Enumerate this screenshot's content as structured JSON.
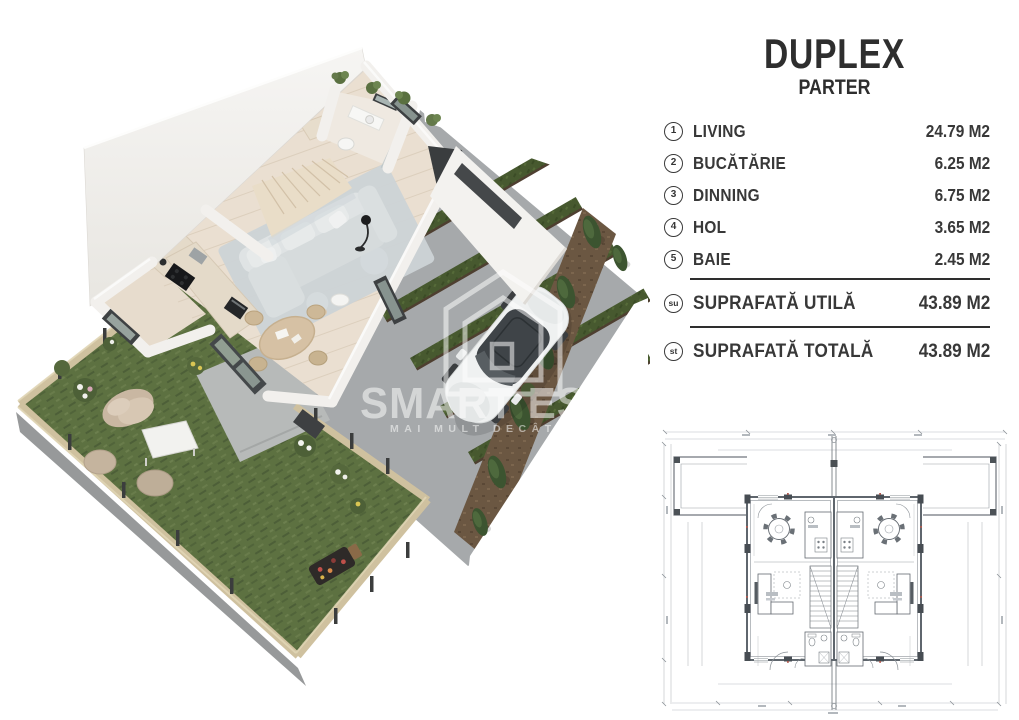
{
  "panel": {
    "title": "DUPLEX",
    "subtitle": "PARTER",
    "rooms": [
      {
        "num": "1",
        "label": "LIVING",
        "area": "24.79 M2"
      },
      {
        "num": "2",
        "label": "BUCĂTĂRIE",
        "area": "6.25 M2"
      },
      {
        "num": "3",
        "label": "DINNING",
        "area": "6.75 M2"
      },
      {
        "num": "4",
        "label": "HOL",
        "area": "3.65 M2"
      },
      {
        "num": "5",
        "label": "BAIE",
        "area": "2.45 M2"
      }
    ],
    "totals": [
      {
        "badge": "su",
        "label": "SUPRAFATĂ UTILĂ",
        "area": "43.89 M2"
      },
      {
        "badge": "st",
        "label": "SUPRAFATĂ TOTALĂ",
        "area": "43.89 M2"
      }
    ]
  },
  "watermark": {
    "brand": "SMART ES",
    "tagline": "MAI MULT DECÂT"
  },
  "colors": {
    "text": "#2e2e2e",
    "grass": "#5d7141",
    "hedge": "#47592f",
    "driveway": "#a6a9ab",
    "mulch": "#6b5742",
    "floor": "#eadfd1",
    "wall": "#f4f3f0",
    "fence": "#cfc19f",
    "car_glass": "#3f4448"
  }
}
